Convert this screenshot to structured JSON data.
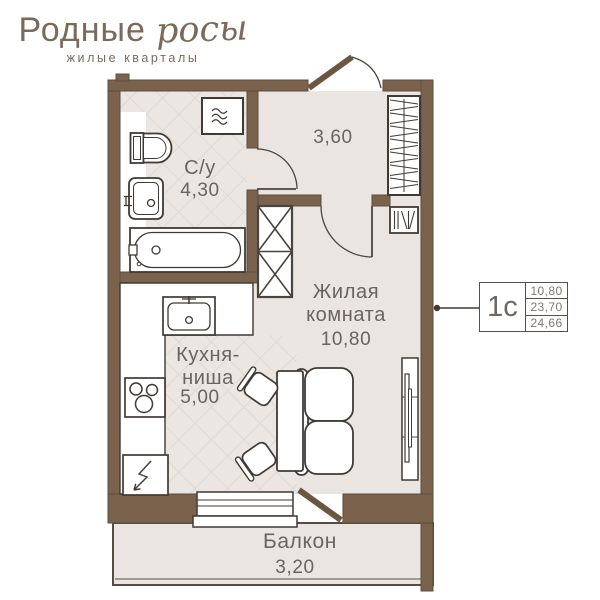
{
  "logo": {
    "title": "Родные",
    "title_script": "росы",
    "subtitle": "жилые кварталы"
  },
  "floorplan": {
    "bathroom_label": "С/у",
    "bathroom_area": "4,30",
    "hall_area": "3,60",
    "living_label_1": "Жилая",
    "living_label_2": "комната",
    "living_area": "10,80",
    "kitchen_label_1": "Кухня-",
    "kitchen_label_2": "ниша",
    "kitchen_area": "5,00",
    "balcony_label": "Балкон",
    "balcony_area": "3,20"
  },
  "callout": {
    "unit": "1с",
    "values": [
      "10,80",
      "23,70",
      "24,66"
    ]
  },
  "icons": {
    "washing_machine": "washing-machine-icon",
    "toilet": "toilet-icon",
    "sink": "sink-icon",
    "bathtub": "bathtub-icon",
    "kitchen_sink": "kitchen-sink-icon",
    "cooktop": "cooktop-icon",
    "fridge": "fridge-icon",
    "wardrobe": "wardrobe-hangers-icon",
    "shoe_cabinet": "shoe-cabinet-icon"
  },
  "colors": {
    "wall": "#7b624d",
    "floor": "#eae5e1",
    "brand": "#7d6958",
    "plan_text": "#6a645e",
    "line": "#3f3a35"
  }
}
